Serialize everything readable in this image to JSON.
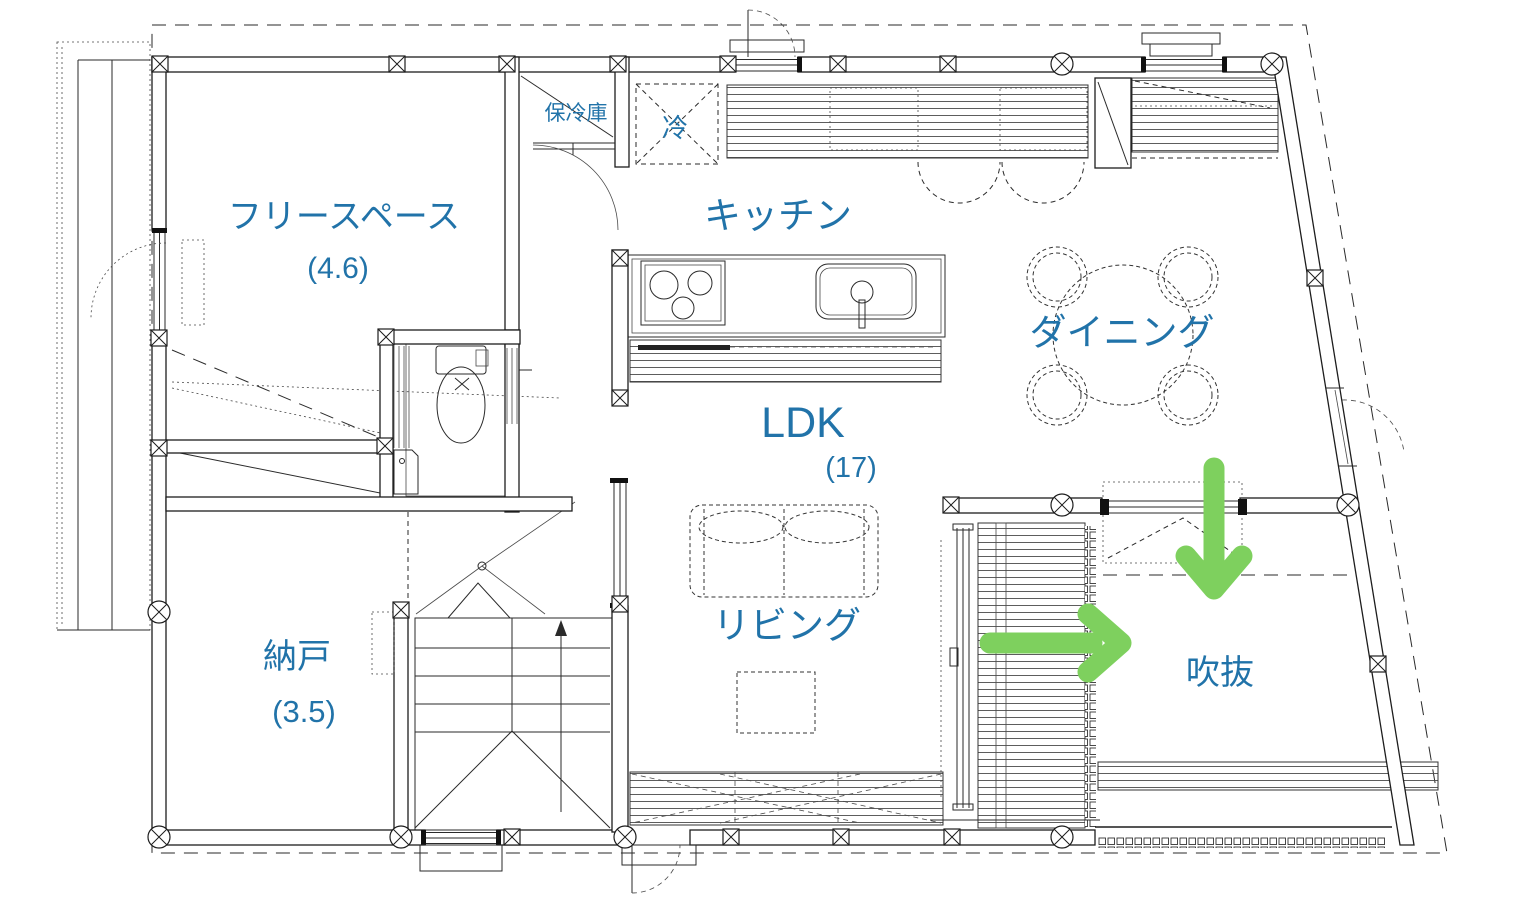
{
  "plan": {
    "rooms": [
      {
        "id": "freespace",
        "label": "フリースペース",
        "size": "(4.6)"
      },
      {
        "id": "kitchen",
        "label": "キッチン"
      },
      {
        "id": "dining",
        "label": "ダイニング"
      },
      {
        "id": "ldk",
        "label": "LDK",
        "size": "(17)"
      },
      {
        "id": "living",
        "label": "リビング"
      },
      {
        "id": "storage",
        "label": "納戸",
        "size": "(3.5)"
      },
      {
        "id": "void",
        "label": "吹抜"
      }
    ],
    "fixtures": [
      {
        "id": "cold-storage",
        "label": "保冷庫"
      },
      {
        "id": "refrigerator",
        "label": "冷"
      }
    ],
    "arrows": [
      {
        "id": "down",
        "name": "airflow-down-arrow"
      },
      {
        "id": "right",
        "name": "airflow-right-arrow"
      }
    ],
    "colors": {
      "label_blue": "#2173a9",
      "arrow_green": "#7ed05e",
      "line_dark": "#1d1d1d"
    }
  }
}
